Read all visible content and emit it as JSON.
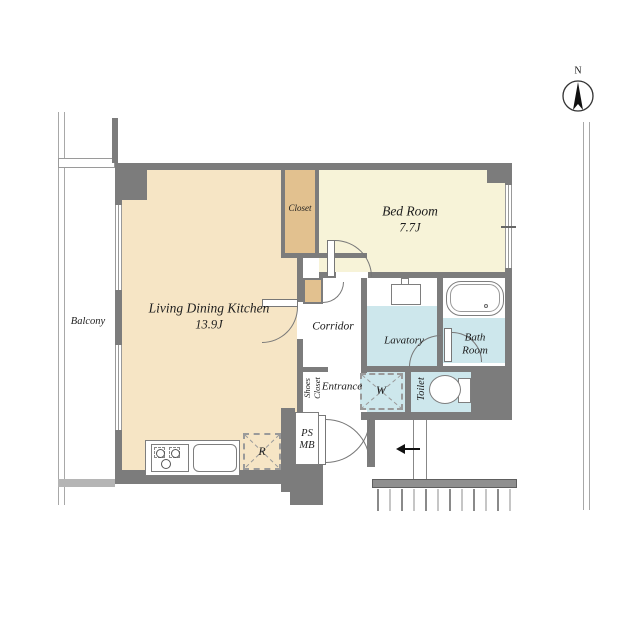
{
  "compass": {
    "label": "N"
  },
  "rooms": {
    "balcony": {
      "label": "Balcony"
    },
    "ldk": {
      "label": "Living Dining Kitchen",
      "area": "13.9J"
    },
    "bedroom": {
      "label": "Bed Room",
      "area": "7.7J"
    },
    "closet": {
      "label": "Closet"
    },
    "corridor": {
      "label": "Corridor"
    },
    "lavatory": {
      "label": "Lavatory"
    },
    "bathroom": {
      "line1": "Bath",
      "line2": "Room"
    },
    "toilet": {
      "label": "Toilet"
    },
    "shoes_closet": {
      "line1": "Shoes",
      "line2": "Closet"
    },
    "entrance": {
      "label": "Entrance"
    },
    "pipe_space": {
      "line1": "PS",
      "line2": "MB"
    }
  },
  "fixtures": {
    "washing_machine": "W",
    "refrigerator": "R"
  },
  "colors": {
    "wall": "#7c7c7c",
    "ldk_floor": "#f6e5c5",
    "closet_floor": "#e2c18f",
    "bedroom_floor": "#f7f3d8",
    "wet_area_floor": "#cde7ec"
  }
}
